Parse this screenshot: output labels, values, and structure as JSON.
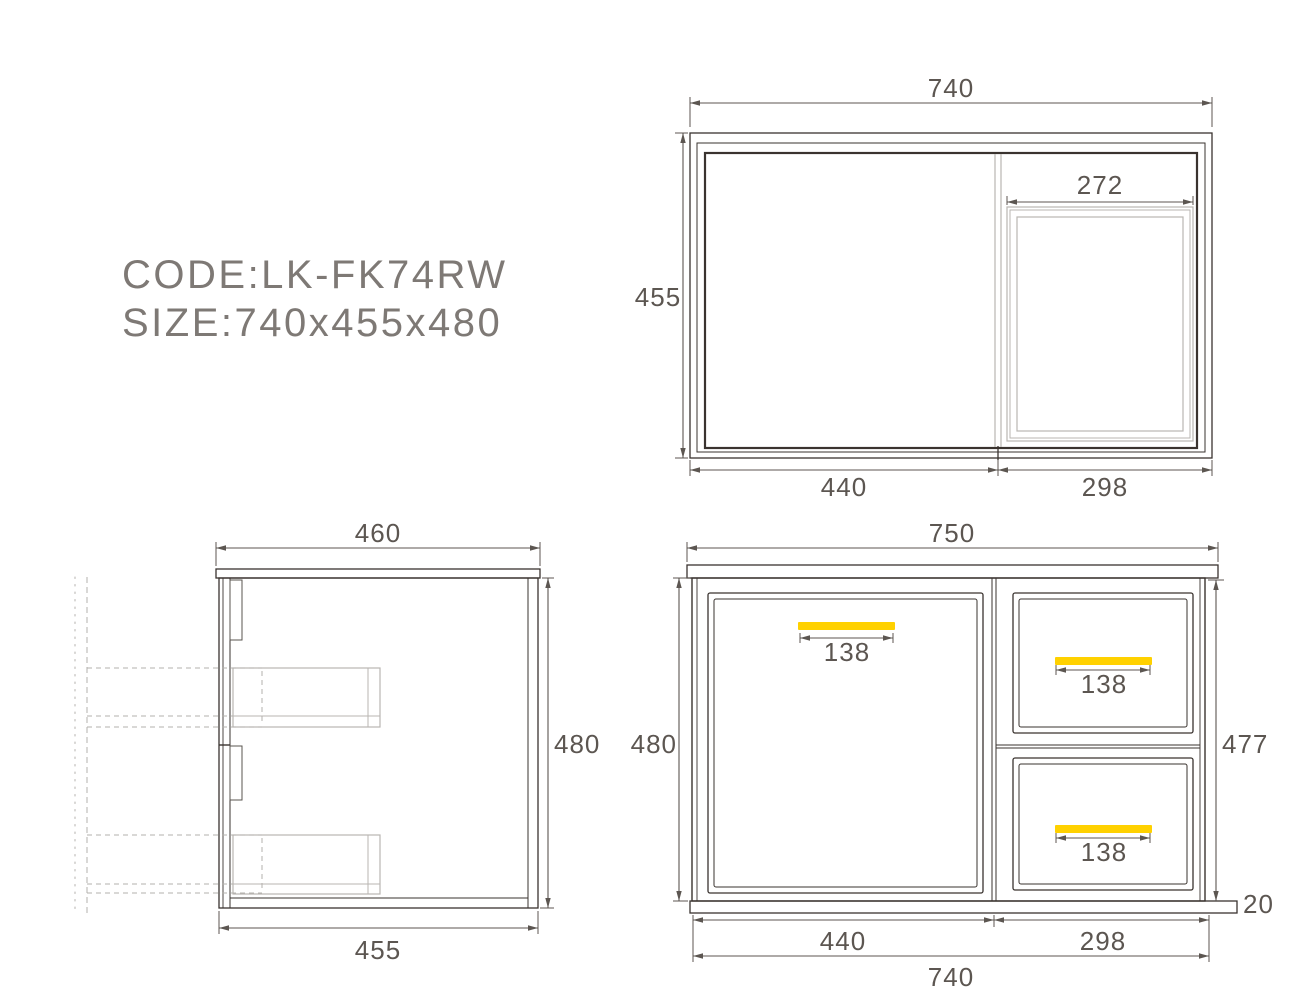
{
  "header": {
    "code": "CODE:LK-FK74RW",
    "size": "SIZE:740x455x480"
  },
  "colors": {
    "line_dark": "#3a332f",
    "dim_gray": "#5c5651",
    "light_gray": "#b9b6b2",
    "dash_gray": "#b3b0ac",
    "hinge_gray": "#5a544f",
    "label_gray": "#7e7975",
    "handle_yellow": "#ffd100"
  },
  "top_view": {
    "width": "740",
    "depth": "455",
    "sink_width": "272",
    "left_width": "440",
    "right_width": "298"
  },
  "side_view": {
    "top_depth": "460",
    "height": "480",
    "bottom_depth": "455"
  },
  "front_view": {
    "top_width": "750",
    "left_height": "480",
    "right_height": "477",
    "door_width": "440",
    "drawers_width": "298",
    "total_width": "740",
    "base_height": "20",
    "door_handle_width": "138",
    "drawer1_handle_width": "138",
    "drawer2_handle_width": "138"
  }
}
